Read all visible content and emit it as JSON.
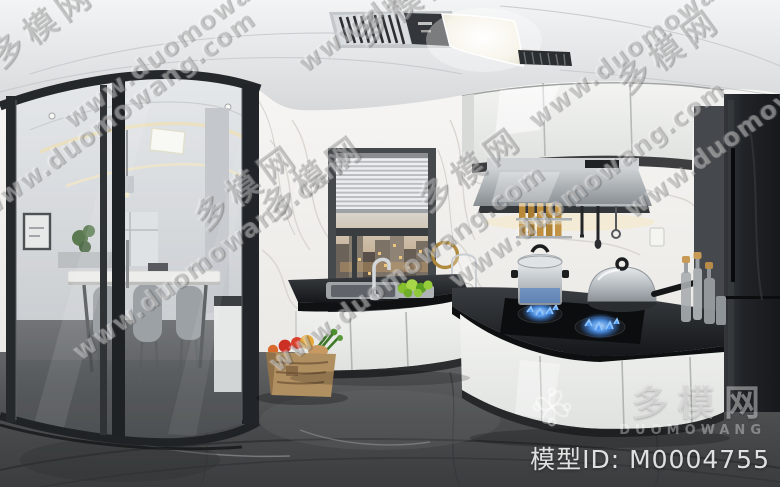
{
  "watermark": {
    "url_text": "www.duomowang.com",
    "brand_text": "多模网"
  },
  "badge": {
    "brand_cn": "多模网",
    "brand_en": "DUOMOWANG",
    "model_id_label": "模型ID:",
    "model_id_value": "M0004755"
  },
  "scene": {
    "icons": {
      "brand_logo": "flower-knot-icon"
    },
    "colors": {
      "ceiling_white": "#e9ebec",
      "cabinet_white": "#eef0ee",
      "counter_black": "#1c1f22",
      "floor_marble_gray": "#4c4e50",
      "wall_marble_white": "#f4f3f1",
      "flame_blue": "#3f8ff0",
      "brass_gold": "#b08a3e",
      "vegetable_green": "#8fc83a",
      "sunset_city_warm": "#c79d6a",
      "fridge_black": "#232528",
      "watermark_white": "#ffffff"
    }
  }
}
